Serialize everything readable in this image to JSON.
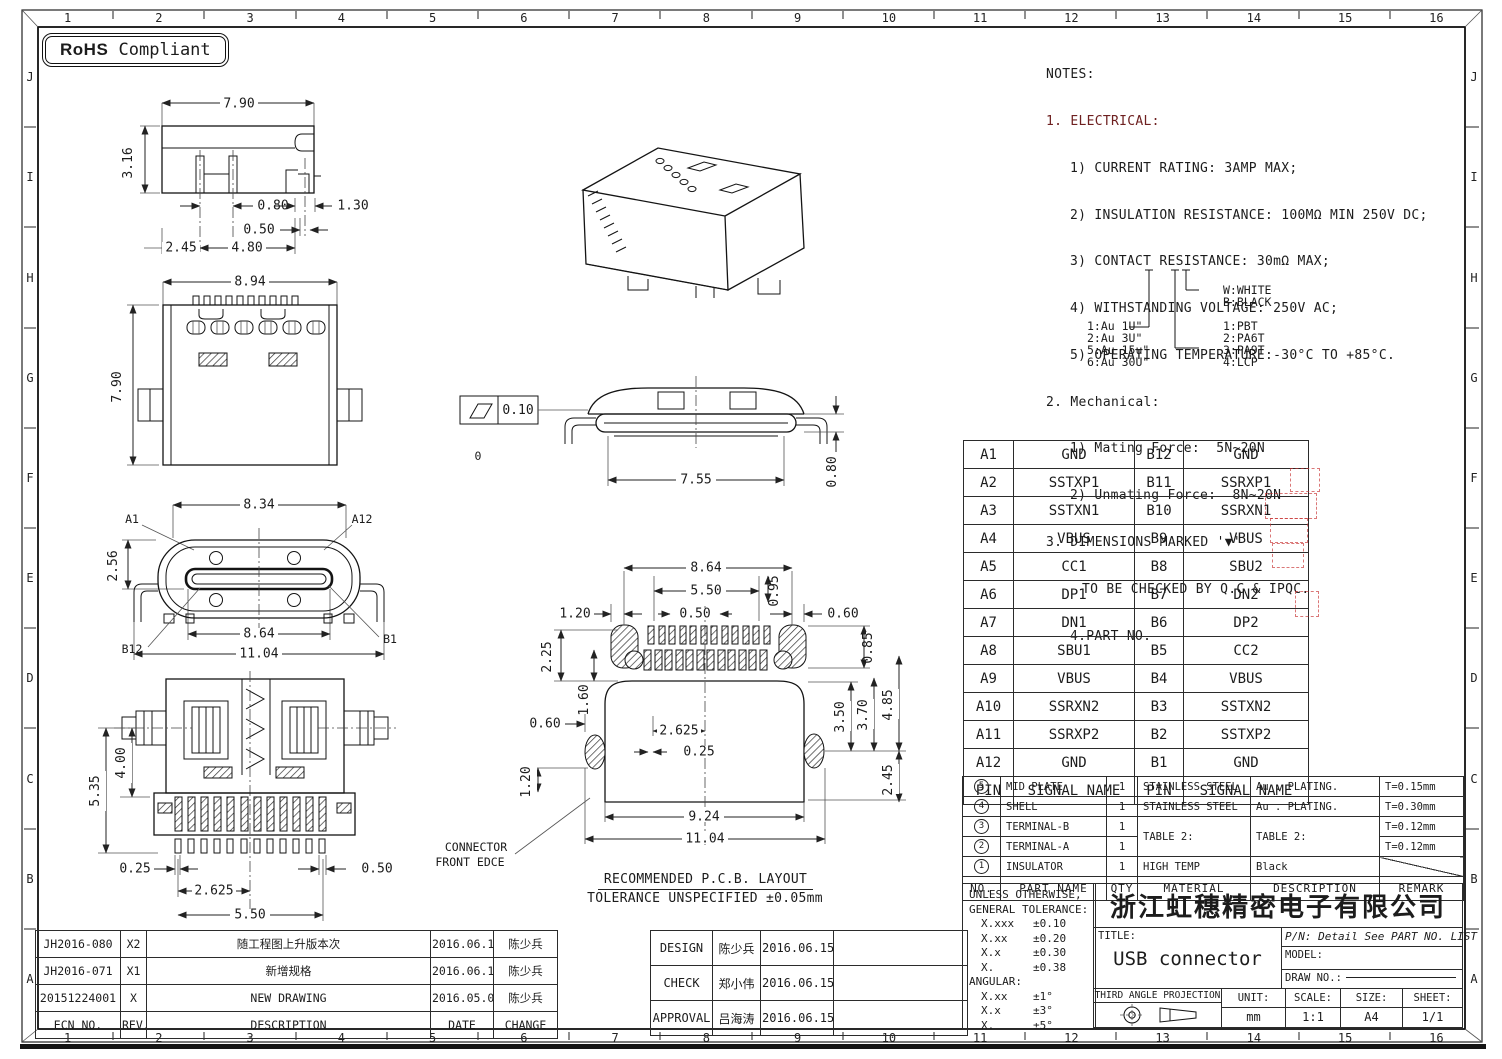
{
  "sheet": {
    "rohs": {
      "bold": "RoHS",
      "rest": "Compliant"
    },
    "cols": [
      "1",
      "2",
      "3",
      "4",
      "5",
      "6",
      "7",
      "8",
      "9",
      "10",
      "11",
      "12",
      "13",
      "14",
      "15",
      "16"
    ],
    "rows_letters": [
      "J",
      "I",
      "H",
      "G",
      "F",
      "E",
      "D",
      "C",
      "B",
      "A"
    ]
  },
  "notes": {
    "l1": "NOTES:",
    "l2": "1. ELECTRICAL:",
    "l3": "1) CURRENT RATING: 3AMP MAX;",
    "l4": "2) INSULATION RESISTANCE: 100MΩ MIN 250V DC;",
    "l5": "3) CONTACT RESISTANCE: 30mΩ MAX;",
    "l6": "4) WITHSTANDING VOLTAGE: 250V AC;",
    "l7": "5) OPERATING TEMPERATURE:-30°C TO +85°C.",
    "l8": "2. Mechanical:",
    "l9": "1) Mating Force:  5N~20N",
    "l10": "2) Unmating Force:  8N~20N",
    "l11": "3. DIMENSIONS MARKED '▼'",
    "l12": "TO BE CHECKED BY Q.C & IPQC.",
    "l13": "4.PART NO."
  },
  "legend": {
    "plating": [
      "1:Au 1U\"",
      "2:Au 3U\"",
      "5:Au 15u\"",
      "6:Au 30U\""
    ],
    "colors": [
      "W:WHITE",
      "B:BLACK"
    ],
    "materials": [
      "1:PBT",
      "2:PA6T",
      "3:PA9T",
      "4:LCP"
    ]
  },
  "pin_table": {
    "header_pin": "PIN",
    "header_signal": "SIGNAL NAME",
    "rows": [
      {
        "pa": "A1",
        "sa": "GND",
        "pb": "B12",
        "sb": "GND"
      },
      {
        "pa": "A2",
        "sa": "SSTXP1",
        "pb": "B11",
        "sb": "SSRXP1"
      },
      {
        "pa": "A3",
        "sa": "SSTXN1",
        "pb": "B10",
        "sb": "SSRXN1"
      },
      {
        "pa": "A4",
        "sa": "VBUS",
        "pb": "B9",
        "sb": "VBUS"
      },
      {
        "pa": "A5",
        "sa": "CC1",
        "pb": "B8",
        "sb": "SBU2"
      },
      {
        "pa": "A6",
        "sa": "DP1",
        "pb": "B7",
        "sb": "DN2"
      },
      {
        "pa": "A7",
        "sa": "DN1",
        "pb": "B6",
        "sb": "DP2"
      },
      {
        "pa": "A8",
        "sa": "SBU1",
        "pb": "B5",
        "sb": "CC2"
      },
      {
        "pa": "A9",
        "sa": "VBUS",
        "pb": "B4",
        "sb": "VBUS"
      },
      {
        "pa": "A10",
        "sa": "SSRXN2",
        "pb": "B3",
        "sb": "SSTXN2"
      },
      {
        "pa": "A11",
        "sa": "SSRXP2",
        "pb": "B2",
        "sb": "SSTXP2"
      },
      {
        "pa": "A12",
        "sa": "GND",
        "pb": "B1",
        "sb": "GND"
      }
    ]
  },
  "bom": {
    "header": {
      "no": "NO.",
      "part": "PART NAME",
      "qty": "QTY",
      "material": "MATERIAL",
      "description": "DESCRIPTION",
      "remark": "REMARK"
    },
    "rows": [
      {
        "no": "5",
        "part": "MID PLATE",
        "qty": "1",
        "material": "STAINLESS STEEL",
        "description": "Au . PLATING.",
        "remark": "T=0.15mm"
      },
      {
        "no": "4",
        "part": "SHELL",
        "qty": "1",
        "material": "STAINLESS STEEL",
        "description": "Au . PLATING.",
        "remark": "T=0.30mm"
      },
      {
        "no": "3",
        "part": "TERMINAL-B",
        "qty": "1",
        "material": "TABLE 2:",
        "description": "TABLE 2:",
        "remark": "T=0.12mm"
      },
      {
        "no": "2",
        "part": "TERMINAL-A",
        "qty": "1",
        "material": "",
        "description": "",
        "remark": "T=0.12mm"
      },
      {
        "no": "1",
        "part": "INSULATOR",
        "qty": "1",
        "material": "HIGH TEMP",
        "description": "Black",
        "remark": ""
      }
    ]
  },
  "tolerances": {
    "l1": "UNLESS OTHERWISE,",
    "l2": "GENERAL TOLERANCE:",
    "items": [
      {
        "k": "X.xxx",
        "v": "±0.10"
      },
      {
        "k": "X.xx",
        "v": "±0.20"
      },
      {
        "k": "X.x",
        "v": "±0.30"
      },
      {
        "k": "X.",
        "v": "±0.38"
      }
    ],
    "angular_label": "ANGULAR:",
    "angular": [
      {
        "k": "X.xx",
        "v": "±1°"
      },
      {
        "k": "X.x",
        "v": "±3°"
      },
      {
        "k": "X.",
        "v": "±5°"
      }
    ]
  },
  "title_block": {
    "company": "浙江虹穗精密电子有限公司",
    "title_label": "TITLE:",
    "title_value": "USB connector",
    "pn": "P/N: Detail See PART NO. LIST",
    "model_label": "MODEL:",
    "draw_no_label": "DRAW NO.:",
    "projection": "THIRD ANGLE PROJECTION",
    "unit_label": "UNIT:",
    "unit_value": "mm",
    "scale_label": "SCALE:",
    "scale_value": "1:1",
    "size_label": "SIZE:",
    "size_value": "A4",
    "sheet_label": "SHEET:",
    "sheet_value": "1/1"
  },
  "revisions": {
    "header": {
      "ecn": "ECN NO.",
      "rev": "REV.",
      "description": "DESCRIPTION",
      "date": "DATE",
      "change": "CHANGE"
    },
    "rows": [
      {
        "ecn": "JH2016-080",
        "rev": "X2",
        "description": "随工程图上升版本次",
        "date": "2016.06.15",
        "change": "陈少兵"
      },
      {
        "ecn": "JH2016-071",
        "rev": "X1",
        "description": "新增规格",
        "date": "2016.06.10",
        "change": "陈少兵"
      },
      {
        "ecn": "20151224001",
        "rev": "X",
        "description": "NEW DRAWING",
        "date": "2016.05.05",
        "change": "陈少兵"
      }
    ]
  },
  "approvals": {
    "rows": [
      {
        "role": "DESIGN",
        "name": "陈少兵",
        "date": "2016.06.15"
      },
      {
        "role": "CHECK",
        "name": "郑小伟",
        "date": "2016.06.15"
      },
      {
        "role": "APPROVAL",
        "name": "吕海涛",
        "date": "2016.06.15"
      }
    ]
  },
  "drawings": {
    "side": {
      "w": "7.90",
      "h": "3.16",
      "d1": "0.80",
      "d2": "1.30",
      "d3": "0.50",
      "d4": "2.45",
      "d5": "4.80"
    },
    "top": {
      "w": "8.94",
      "h": "7.90"
    },
    "profile": {
      "flatness": "0.10",
      "w": "7.55",
      "h": "0.80",
      "stray": "0"
    },
    "front": {
      "top": "8.34",
      "left": "2.56",
      "mid": "8.64",
      "bottom": "11.04",
      "a1": "A1",
      "a12": "A12",
      "b12": "B12",
      "b1": "B1"
    },
    "bottom": {
      "h1": "5.35",
      "h2": "4.00",
      "d1": "0.25",
      "d2": "0.50",
      "d3": "2.625",
      "d4": "5.50"
    },
    "pcb": {
      "d864": "8.64",
      "d550": "5.50",
      "d095": "0.95",
      "d120a": "1.20",
      "d050": "0.50",
      "d060a": "0.60",
      "d085": "0.85",
      "d225": "2.25",
      "d160": "1.60",
      "d060b": "0.60",
      "d2625": "2.625",
      "d025": "0.25",
      "d350": "3.50",
      "d370": "3.70",
      "d485": "4.85",
      "d245": "2.45",
      "d120b": "1.20",
      "d924": "9.24",
      "d1104": "11.04",
      "front_edge1": "CONNECTOR",
      "front_edge2": "FRONT EDCE",
      "note1": "RECOMMENDED  P.C.B. LAYOUT",
      "note2": "TOLERANCE UNSPECIFIED ±0.05mm"
    }
  }
}
